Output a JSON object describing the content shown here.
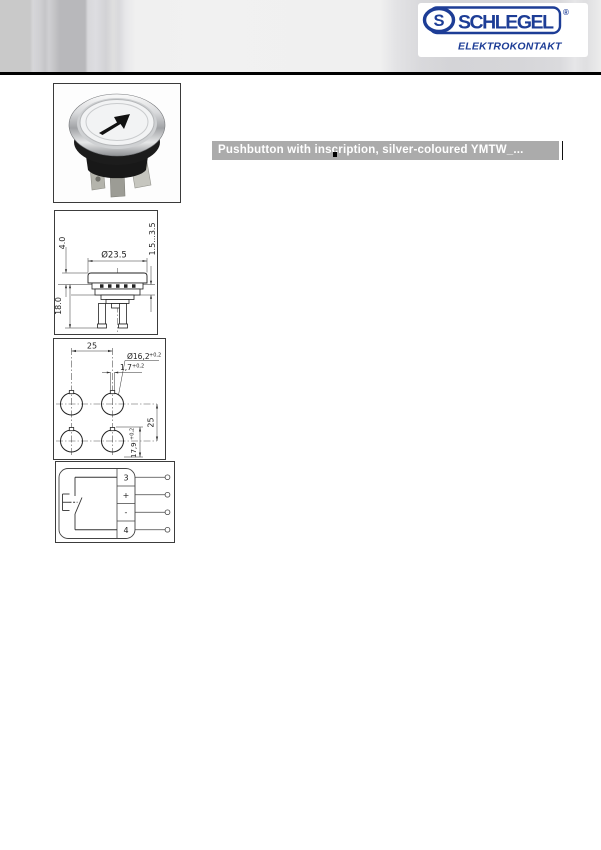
{
  "header": {
    "logo": {
      "brand": "SCHLEGEL",
      "registered": "®",
      "subtitle": "ELEKTROKONTAKT"
    }
  },
  "title_bar": {
    "text": "Pushbutton with inscription, silver-coloured YMTW_..."
  },
  "side_view": {
    "diameter": "Ø23.5",
    "cap_height": "4.0",
    "mount_depth": "18.0",
    "panel_thickness": "1.5...3.5"
  },
  "drill_plan": {
    "pitch_horizontal": "25",
    "hole_diameter": "Ø16,2",
    "hole_tolerance": "+0,2",
    "notch_width": "1,7",
    "notch_tolerance": "+0,2",
    "pitch_vertical": "25",
    "notch_distance": "17,9",
    "notch_distance_tolerance": "+0,2"
  },
  "circuit": {
    "terminals": [
      "3",
      "+",
      "-",
      "4"
    ]
  },
  "colors": {
    "logo_blue": "#1d3d96",
    "title_bar_bg": "#ababab",
    "header_rule": "#000000"
  }
}
